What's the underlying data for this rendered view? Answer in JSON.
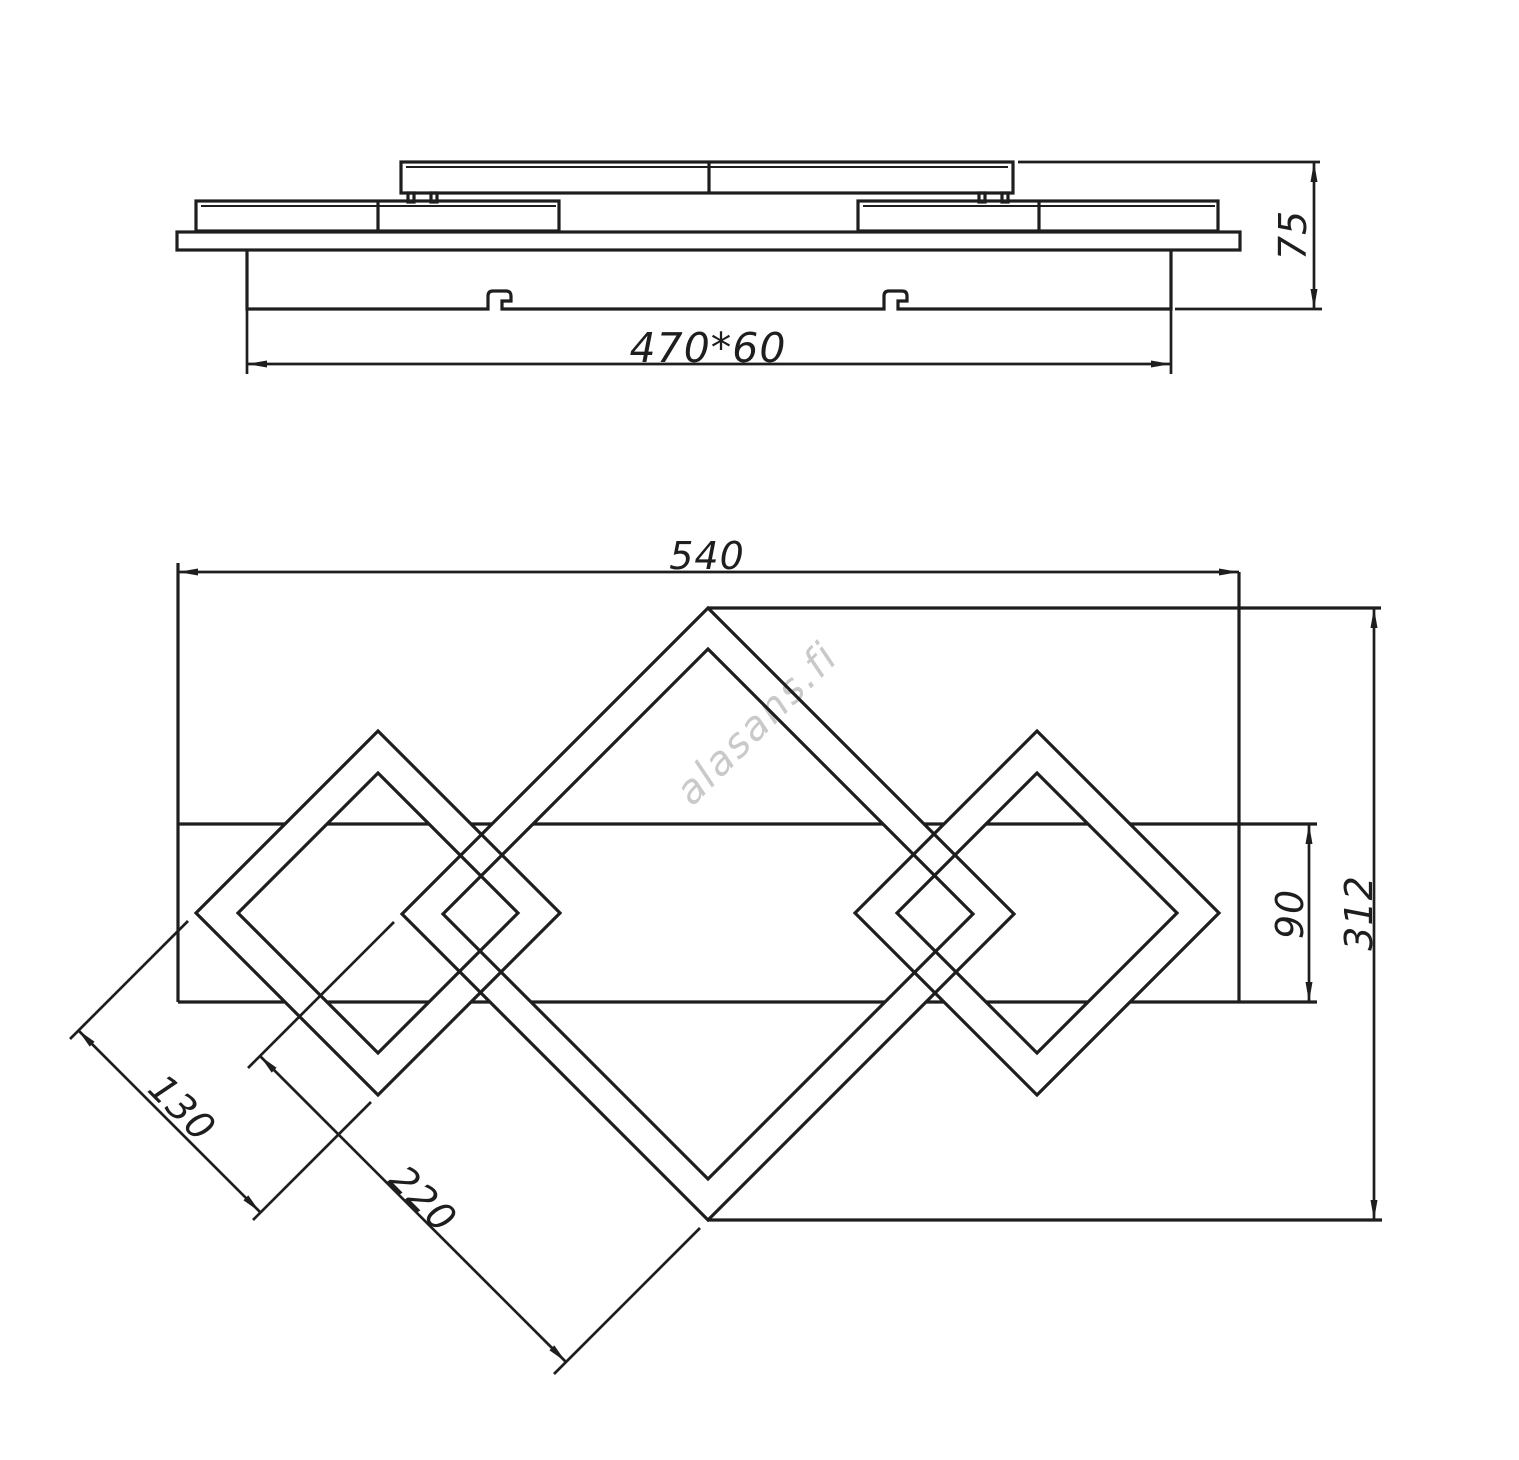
{
  "colors": {
    "line": "#1e1e1e",
    "dim": "#1e1e1e",
    "watermark": "#c9c9c9",
    "background": "#ffffff"
  },
  "watermark": {
    "text": "alasans.fi"
  },
  "side_view": {
    "description": "side elevation of ceiling light fixture",
    "dim_bracket": "470*60",
    "dim_height": "75"
  },
  "plan_view": {
    "description": "plan view with three interlocking square frames on a band",
    "dim_width": "540",
    "dim_height": "312",
    "dim_band": "90",
    "dim_small_diamond": "130",
    "dim_large_diamond": "220"
  }
}
